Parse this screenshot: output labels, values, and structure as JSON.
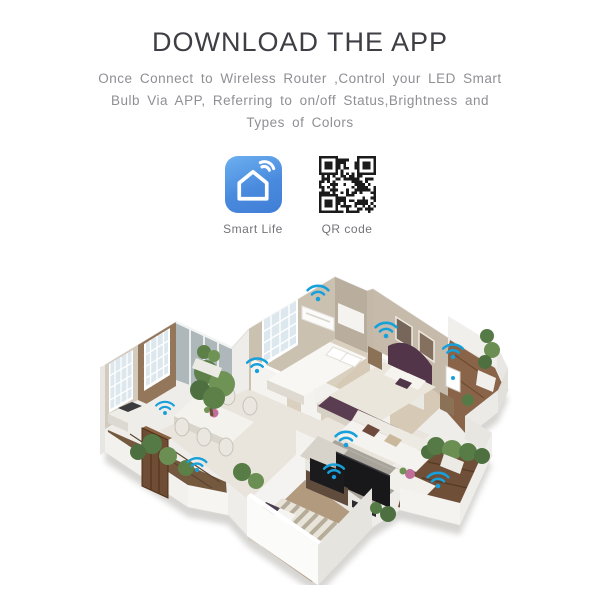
{
  "page": {
    "bg_color": "#ffffff"
  },
  "header": {
    "title": "DOWNLOAD THE APP",
    "color": "#3e3e44"
  },
  "description": {
    "color": "#8f8f94",
    "lines": [
      "Once Connect to Wireless Router ,Control your LED Smart",
      "Bulb Via APP, Referring to on/off Status,Brightness and",
      "Types of Colors"
    ]
  },
  "apps": {
    "smart_life": {
      "label": "Smart Life",
      "icon": "smart-life-app-icon",
      "gradient_top": "#6cb0f0",
      "gradient_bottom": "#3f7ed5",
      "glyph_color": "#ffffff"
    },
    "qr_code": {
      "label": "QR code",
      "icon": "qr-code-icon",
      "module_color": "#1b1b1b"
    }
  },
  "illustration": {
    "name": "isometric-smart-home-floor-plan",
    "wifi_icon": "wifi-icon",
    "wifi_color": "#17a0da",
    "wifi_icon_count": 9
  }
}
